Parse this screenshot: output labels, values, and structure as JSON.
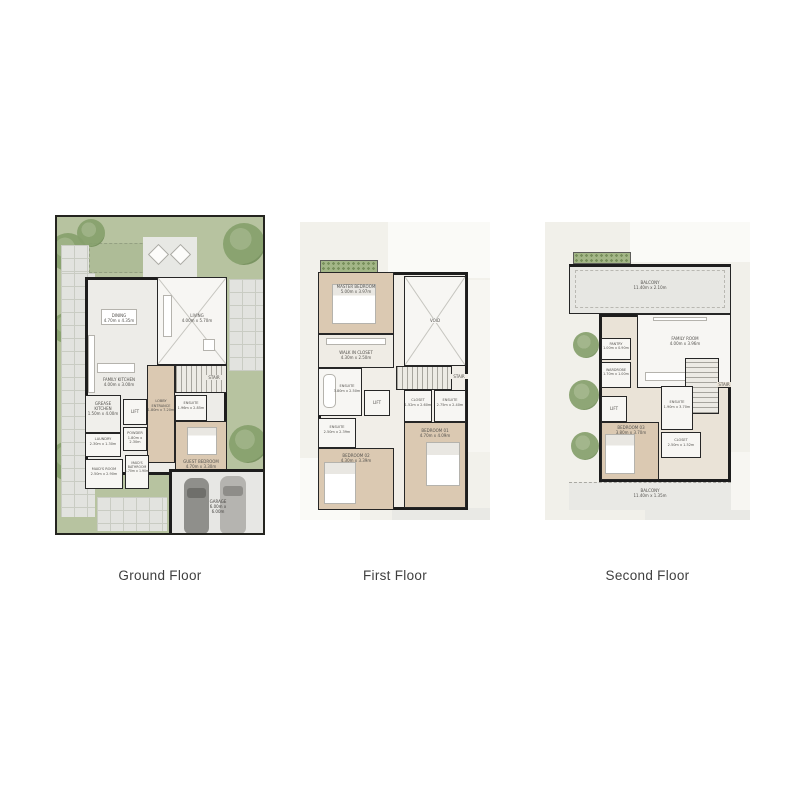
{
  "colors": {
    "wall": "#1d1d1d",
    "garden_green": "#b7c3a0",
    "wood_floor": "#dbc9b2",
    "pale_floor": "#f2f1eb",
    "paver_gray": "#e2e3df",
    "car_dark": "#8f8f8b",
    "car_light": "#b5b4b0"
  },
  "floors": {
    "ground": {
      "caption": "Ground Floor",
      "rooms": {
        "dining": {
          "label": "DINING\n4.70m x 4.35m"
        },
        "living": {
          "label": "LIVING\n4.00m x 5.70m"
        },
        "family_kitchen": {
          "label": "FAMILY KITCHEN\n4.00m x 3.00m"
        },
        "grease_kitchen": {
          "label": "GREASE\nKITCHEN\n1.50m x 4.00m"
        },
        "lift": {
          "label": "LIFT"
        },
        "powder": {
          "label": "POWDER\n1.80m x 2.30m"
        },
        "lobby": {
          "label": "LOBBY\nENTRANCE\n1.80m x 7.20m"
        },
        "stair": {
          "label": "STAIR"
        },
        "ensuite": {
          "label": "ENSUITE\n1.96m x 2.85m"
        },
        "guest_bedroom": {
          "label": "GUEST BEDROOM\n4.70m x 3.30m"
        },
        "laundry": {
          "label": "LAUNDRY\n2.30m x 1.30m"
        },
        "maids_room": {
          "label": "MAID'S ROOM\n2.50m x 2.90m"
        },
        "maids_bath": {
          "label": "MAID'S\nBATHROOM\n1.70m x 1.90m"
        },
        "garage": {
          "label": "GARAGE\n6.00m x 6.00m"
        }
      }
    },
    "first": {
      "caption": "First Floor",
      "rooms": {
        "master_bedroom": {
          "label": "MASTER BEDROOM\n5.00m x 3.97m"
        },
        "void": {
          "label": "VOID"
        },
        "walk_in_closet": {
          "label": "WALK IN CLOSET\n4.30m x 2.50m"
        },
        "ensuite_master": {
          "label": "ENSUITE\n3.80m x 2.50m"
        },
        "lift": {
          "label": "LIFT"
        },
        "stair": {
          "label": "STAIR"
        },
        "closet": {
          "label": "CLOSET\n1.52m x 2.60m"
        },
        "ensuite_b1": {
          "label": "ENSUITE\n2.75m x 2.40m"
        },
        "ensuite_b2": {
          "label": "ENSUITE\n2.50m x 2.39m"
        },
        "bedroom02": {
          "label": "BEDROOM 02\n4.30m x 3.39m"
        },
        "bedroom01": {
          "label": "BEDROOM 01\n4.70m x 4.09m"
        }
      }
    },
    "second": {
      "caption": "Second Floor",
      "rooms": {
        "balcony_top": {
          "label": "BALCONY\n11.40m x 2.10m"
        },
        "family_room": {
          "label": "FAMILY ROOM\n4.00m x 3.96m"
        },
        "pantry": {
          "label": "PANTRY\n1.00m x 0.90m"
        },
        "wardrobe": {
          "label": "WARDROBE\n1.70m x 1.00m"
        },
        "lift": {
          "label": "LIFT"
        },
        "stair": {
          "label": "STAIR"
        },
        "bedroom03": {
          "label": "BEDROOM 03\n3.80m x 3.70m"
        },
        "ensuite": {
          "label": "ENSUITE\n1.90m x 3.70m"
        },
        "closet": {
          "label": "CLOSET\n2.50m x 1.52m"
        },
        "balcony_bottom": {
          "label": "BALCONY\n11.40m x 1.35m"
        }
      }
    }
  }
}
